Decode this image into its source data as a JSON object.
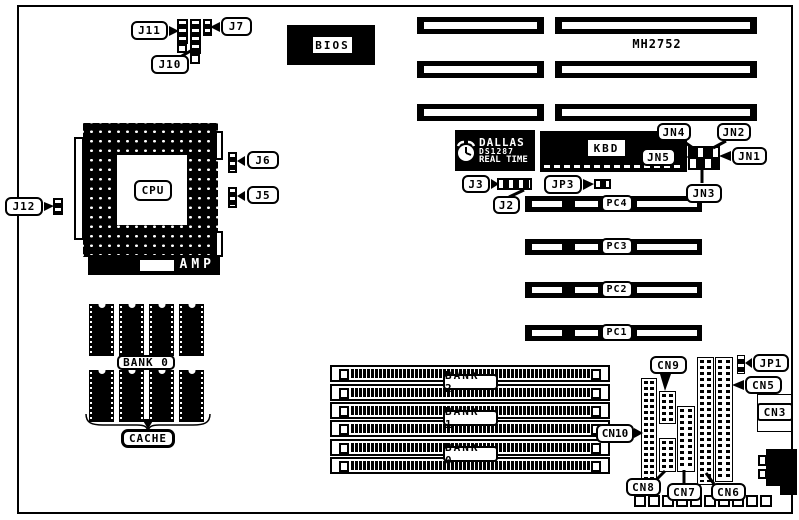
{
  "connector_labels": {
    "j2": "J2",
    "j3": "J3",
    "j5": "J5",
    "j6": "J6",
    "j7": "J7",
    "j10": "J10",
    "j11": "J11",
    "j12": "J12",
    "jp1": "JP1",
    "jp3": "JP3",
    "jn1": "JN1",
    "jn2": "JN2",
    "jn3": "JN3",
    "jn4": "JN4",
    "jn5": "JN5",
    "cn3": "CN3",
    "cn5": "CN5",
    "cn6": "CN6",
    "cn7": "CN7",
    "cn8": "CN8",
    "cn9": "CN9",
    "cn10": "CN10"
  },
  "chips": {
    "bios": "BIOS",
    "cpu": "CPU",
    "cpu_socket_brand": "AMP",
    "kbd": "KBD",
    "board_model": "MH2752",
    "rtc": {
      "brand": "DALLAS",
      "part": "DS1287",
      "line": "REAL TIME"
    }
  },
  "slots": {
    "pci": [
      {
        "label": "PC4"
      },
      {
        "label": "PC3"
      },
      {
        "label": "PC2"
      },
      {
        "label": "PC1"
      }
    ],
    "simm": [
      {
        "label": "BANK 2"
      },
      {
        "label": "BANK 1"
      },
      {
        "label": "BANK 0"
      }
    ]
  },
  "cache": {
    "bank": "BANK 0",
    "label": "CACHE"
  }
}
